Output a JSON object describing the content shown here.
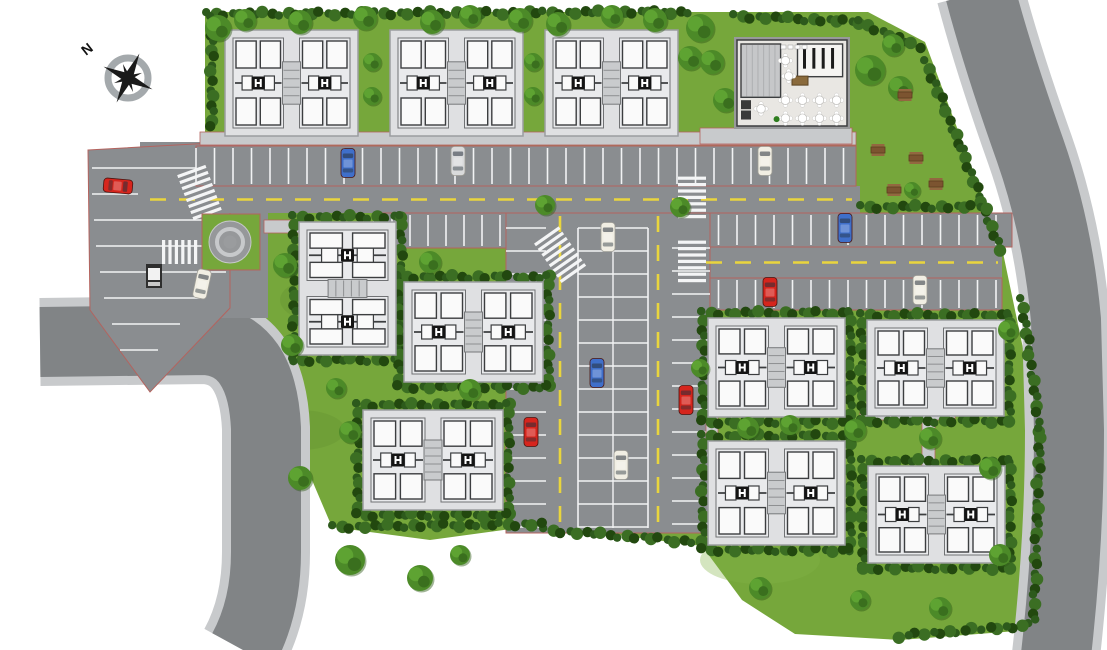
{
  "meta": {
    "title": "Residential community site master plan",
    "kind": "aerial-site-plan"
  },
  "compass": {
    "label": "N",
    "cx": 128,
    "cy": 78
  },
  "palette": {
    "background": "#ffffff",
    "grass": "#76a73b",
    "grass_light": "#85b449",
    "grass_dark": "#649331",
    "hedge_dark": "#2d5a1c",
    "hedge_mid": "#3b6e23",
    "hedge_deep": "#22480f",
    "asphalt": "#8a8d90",
    "sidewalk": "#c8cacc",
    "stall_line": "#f2f3f4",
    "lane_yellow": "#e9d53d",
    "boundary_red": "#b4635e",
    "plate": "#dfe0e2",
    "unit_fill": "#e9eaec",
    "room_white": "#fafafa",
    "wall_dark": "#3c3e40",
    "core_black": "#141414",
    "club_floor": "#e9e7e3",
    "club_hall": "#c6c7c9",
    "wood_brown": "#7c5430",
    "car_red": "#d6251d",
    "car_blue": "#3f6fca",
    "car_white": "#f1eee3",
    "car_silver": "#d9dadb",
    "compass_ring": "#9aa0a3",
    "compass_star": "#1a1a1a"
  },
  "site": {
    "outline": [
      [
        205,
        12
      ],
      [
        868,
        12
      ],
      [
        925,
        42
      ],
      [
        1002,
        248
      ],
      [
        1038,
        420
      ],
      [
        1030,
        630
      ],
      [
        900,
        640
      ],
      [
        795,
        634
      ],
      [
        742,
        600
      ],
      [
        702,
        546
      ],
      [
        540,
        525
      ],
      [
        430,
        540
      ],
      [
        332,
        527
      ],
      [
        300,
        452
      ],
      [
        282,
        388
      ],
      [
        205,
        332
      ]
    ]
  },
  "roads": {
    "left_road": {
      "d": "M 40 342 L 205 340 Q 262 344 266 428 L 266 552 Q 266 608 243 650",
      "width": 70,
      "sidewalk_width": 88
    },
    "right_road": {
      "d": "M 980 -8 Q 998 60 1030 150 Q 1058 230 1066 320 L 1069 430 Q 1069 540 1056 655",
      "width": 70,
      "sidewalk_width": 88
    },
    "junction": {
      "points": [
        [
          140,
          142
        ],
        [
          268,
          142
        ],
        [
          268,
          318
        ],
        [
          140,
          318
        ]
      ]
    },
    "main_road": {
      "x": 138,
      "y": 186,
      "w": 722,
      "h": 27,
      "dash": [
        150,
        199.5,
        852,
        199.5
      ]
    },
    "road_2": {
      "x": 700,
      "y": 247,
      "w": 302,
      "h": 31,
      "dash": [
        706,
        262.5,
        998,
        262.5
      ]
    }
  },
  "paths": [
    {
      "x": 200,
      "y": 132,
      "w": 656,
      "h": 13
    },
    {
      "x": 700,
      "y": 128,
      "w": 152,
      "h": 16
    },
    {
      "x": 860,
      "y": 410,
      "w": 95,
      "h": 10
    },
    {
      "x": 922,
      "y": 420,
      "w": 13,
      "h": 46
    },
    {
      "x": 706,
      "y": 417,
      "w": 12,
      "h": 24
    },
    {
      "x": 264,
      "y": 220,
      "w": 38,
      "h": 13
    }
  ],
  "parking": {
    "rows": [
      {
        "id": "row-top",
        "x": 196,
        "y": 146,
        "w": 660,
        "h": 40,
        "spacing": 18.5
      },
      {
        "id": "row-2-left",
        "x": 374,
        "y": 213,
        "w": 286,
        "h": 35,
        "spacing": 18
      },
      {
        "id": "row-2-right",
        "x": 700,
        "y": 213,
        "w": 312,
        "h": 34,
        "spacing": 18.5
      },
      {
        "id": "row-3-right",
        "x": 700,
        "y": 278,
        "w": 302,
        "h": 32,
        "spacing": 18.5
      }
    ],
    "corridor": {
      "x": 506,
      "y": 213,
      "w": 204,
      "h": 320,
      "left_col": {
        "x": 506,
        "w": 40,
        "y0": 228,
        "spacing": 23
      },
      "spine": {
        "x": 578,
        "w": 70,
        "y0": 228,
        "spacing": 23
      },
      "right_col": {
        "x": 672,
        "w": 38,
        "y0": 248,
        "spacing": 23
      },
      "lane_dash_x": [
        560,
        658
      ],
      "dash_y0": 216,
      "dash_y1": 526
    },
    "west_lot": {
      "points": [
        [
          88,
          150
        ],
        [
          230,
          142
        ],
        [
          230,
          308
        ],
        [
          150,
          392
        ],
        [
          90,
          310
        ]
      ],
      "lines": [
        [
          92,
          168,
          228
        ],
        [
          92,
          194,
          228
        ],
        [
          94,
          220,
          228
        ],
        [
          96,
          246,
          228
        ],
        [
          100,
          272,
          226
        ],
        [
          104,
          298,
          200
        ],
        [
          112,
          324,
          180
        ],
        [
          120,
          350,
          158
        ]
      ]
    }
  },
  "crosswalks": [
    {
      "cx": 200,
      "cy": 194,
      "rot": -20,
      "n": 8,
      "len": 30
    },
    {
      "cx": 178,
      "cy": 252,
      "rot": 90,
      "n": 6,
      "len": 24
    },
    {
      "cx": 561,
      "cy": 256,
      "rot": -35,
      "n": 8,
      "len": 30
    },
    {
      "cx": 692,
      "cy": 199,
      "rot": 0,
      "n": 7,
      "len": 28
    },
    {
      "cx": 692,
      "cy": 263,
      "rot": 0,
      "n": 7,
      "len": 28
    }
  ],
  "buildings": [
    {
      "id": "T1",
      "x": 225,
      "y": 30,
      "w": 133,
      "h": 106,
      "dir": "h",
      "hedge": "none"
    },
    {
      "id": "T2",
      "x": 390,
      "y": 30,
      "w": 133,
      "h": 106,
      "dir": "h",
      "hedge": "none"
    },
    {
      "id": "T3",
      "x": 545,
      "y": 30,
      "w": 133,
      "h": 106,
      "dir": "h",
      "hedge": "none"
    },
    {
      "id": "L1",
      "x": 299,
      "y": 222,
      "w": 97,
      "h": 133,
      "dir": "v",
      "hedge": "ring"
    },
    {
      "id": "L2",
      "x": 404,
      "y": 282,
      "w": 139,
      "h": 100,
      "dir": "h",
      "hedge": "ring"
    },
    {
      "id": "L3",
      "x": 363,
      "y": 410,
      "w": 140,
      "h": 100,
      "dir": "h",
      "hedge": "ring"
    },
    {
      "id": "R1",
      "x": 708,
      "y": 318,
      "w": 137,
      "h": 99,
      "dir": "h",
      "hedge": "ring"
    },
    {
      "id": "R2",
      "x": 867,
      "y": 320,
      "w": 137,
      "h": 96,
      "dir": "h",
      "hedge": "ring"
    },
    {
      "id": "R3",
      "x": 708,
      "y": 441,
      "w": 137,
      "h": 104,
      "dir": "h",
      "hedge": "ring"
    },
    {
      "id": "R4",
      "x": 868,
      "y": 466,
      "w": 137,
      "h": 97,
      "dir": "h",
      "hedge": "ring"
    }
  ],
  "clubhouse": {
    "x": 737,
    "y": 40,
    "w": 110,
    "h": 86
  },
  "roundabout": {
    "cx": 230,
    "cy": 242,
    "r": 21,
    "patch": [
      202,
      214,
      58,
      56
    ]
  },
  "security_booth": {
    "x": 146,
    "y": 264
  },
  "picnic_tables": [
    [
      905,
      95
    ],
    [
      878,
      150
    ],
    [
      916,
      158
    ],
    [
      936,
      184
    ],
    [
      894,
      190
    ]
  ],
  "cars": [
    {
      "color": "red",
      "x": 118,
      "y": 186,
      "rot": 95
    },
    {
      "color": "white",
      "x": 202,
      "y": 284,
      "rot": 12
    },
    {
      "color": "blue",
      "x": 348,
      "y": 163,
      "rot": 0
    },
    {
      "color": "silver",
      "x": 458,
      "y": 161,
      "rot": 0
    },
    {
      "color": "white",
      "x": 765,
      "y": 161,
      "rot": 0
    },
    {
      "color": "white",
      "x": 608,
      "y": 237,
      "rot": 0
    },
    {
      "color": "blue",
      "x": 845,
      "y": 228,
      "rot": 0
    },
    {
      "color": "red",
      "x": 770,
      "y": 292,
      "rot": 0
    },
    {
      "color": "white",
      "x": 920,
      "y": 290,
      "rot": 0
    },
    {
      "color": "blue",
      "x": 597,
      "y": 373,
      "rot": 0
    },
    {
      "color": "red",
      "x": 686,
      "y": 400,
      "rot": 0
    },
    {
      "color": "red",
      "x": 531,
      "y": 432,
      "rot": 0
    },
    {
      "color": "white",
      "x": 621,
      "y": 465,
      "rot": 0
    }
  ],
  "trees": [
    [
      218,
      28,
      13
    ],
    [
      245,
      20,
      11
    ],
    [
      300,
      22,
      12
    ],
    [
      365,
      18,
      12
    ],
    [
      372,
      62,
      9
    ],
    [
      372,
      96,
      9
    ],
    [
      432,
      22,
      12
    ],
    [
      470,
      16,
      11
    ],
    [
      520,
      20,
      12
    ],
    [
      533,
      62,
      9
    ],
    [
      533,
      96,
      9
    ],
    [
      558,
      24,
      12
    ],
    [
      612,
      16,
      11
    ],
    [
      655,
      20,
      12
    ],
    [
      690,
      58,
      12
    ],
    [
      700,
      28,
      14
    ],
    [
      712,
      62,
      12
    ],
    [
      725,
      100,
      12
    ],
    [
      870,
      70,
      15
    ],
    [
      893,
      45,
      11
    ],
    [
      900,
      88,
      12
    ],
    [
      912,
      190,
      8
    ],
    [
      285,
      265,
      12
    ],
    [
      292,
      345,
      11
    ],
    [
      336,
      388,
      10
    ],
    [
      350,
      432,
      11
    ],
    [
      300,
      478,
      12
    ],
    [
      350,
      560,
      15
    ],
    [
      420,
      578,
      13
    ],
    [
      460,
      555,
      10
    ],
    [
      430,
      262,
      11
    ],
    [
      470,
      390,
      11
    ],
    [
      545,
      205,
      10
    ],
    [
      680,
      207,
      10
    ],
    [
      748,
      428,
      11
    ],
    [
      790,
      425,
      10
    ],
    [
      855,
      430,
      11
    ],
    [
      930,
      438,
      11
    ],
    [
      990,
      468,
      11
    ],
    [
      1000,
      555,
      11
    ],
    [
      940,
      608,
      11
    ],
    [
      860,
      600,
      10
    ],
    [
      760,
      588,
      11
    ],
    [
      700,
      368,
      9
    ],
    [
      1008,
      330,
      10
    ]
  ],
  "hedges": [
    [
      [
        208,
        14
      ],
      [
        688,
        12
      ]
    ],
    [
      [
        735,
        16
      ],
      [
        860,
        22
      ],
      [
        920,
        48
      ]
    ],
    [
      [
        926,
        62
      ],
      [
        962,
        150
      ],
      [
        1000,
        250
      ]
    ],
    [
      [
        1022,
        300
      ],
      [
        1040,
        430
      ],
      [
        1034,
        620
      ]
    ],
    [
      [
        1030,
        625
      ],
      [
        900,
        636
      ]
    ],
    [
      [
        545,
        530
      ],
      [
        708,
        543
      ]
    ],
    [
      [
        334,
        527
      ],
      [
        540,
        524
      ]
    ],
    [
      [
        862,
        207
      ],
      [
        988,
        207
      ]
    ],
    [
      [
        212,
        18
      ],
      [
        212,
        128
      ]
    ]
  ],
  "grass_patches": [
    [
      340,
      300,
      60,
      26
    ],
    [
      480,
      470,
      55,
      22
    ],
    [
      820,
      500,
      70,
      28
    ],
    [
      930,
      360,
      55,
      22
    ],
    [
      300,
      430,
      45,
      20
    ],
    [
      760,
      560,
      60,
      24
    ],
    [
      640,
      330,
      30,
      40
    ]
  ]
}
